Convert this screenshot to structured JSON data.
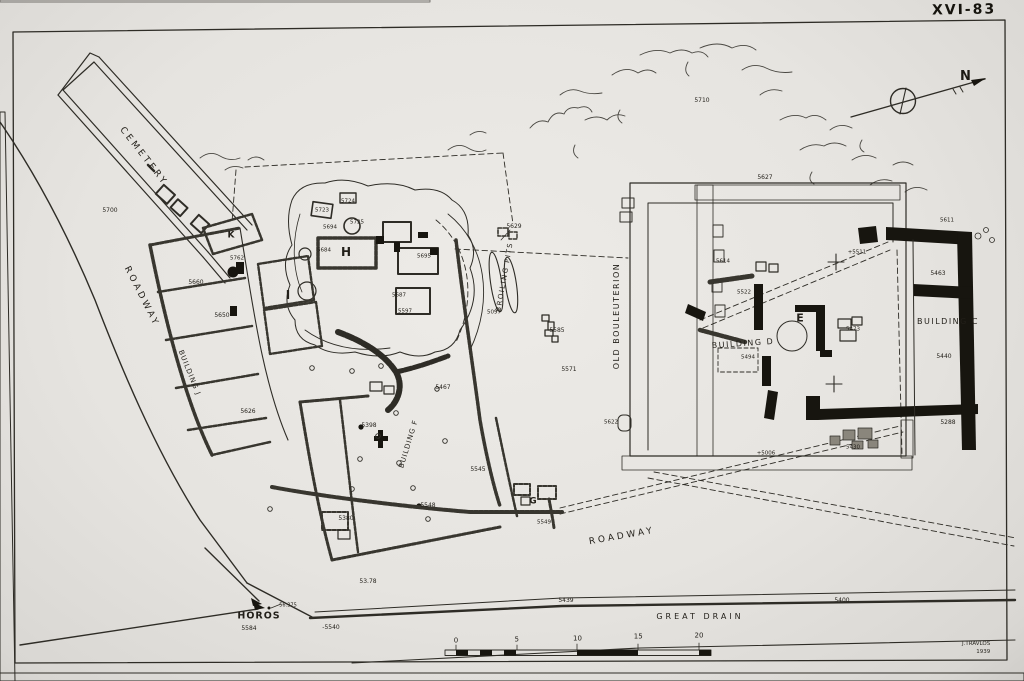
{
  "figure": {
    "plate_number": "XVI-83",
    "compass_label": "N",
    "signature_name": "J.TRAVLOS",
    "signature_year": "1939"
  },
  "scale_bar": {
    "ticks": [
      "0",
      "5",
      "10",
      "15",
      "20"
    ]
  },
  "labels": [
    {
      "t": "CEMETERY",
      "x": 143,
      "y": 157,
      "s": 9,
      "r": 52,
      "ls": 3
    },
    {
      "t": "5700",
      "x": 110,
      "y": 211,
      "s": 6
    },
    {
      "t": "ROADWAY",
      "x": 141,
      "y": 297,
      "s": 9,
      "r": 63,
      "ls": 3
    },
    {
      "t": "K",
      "x": 231,
      "y": 236,
      "s": 9,
      "w": 700
    },
    {
      "t": "5762",
      "x": 237,
      "y": 259,
      "s": 5.5
    },
    {
      "t": "5660",
      "x": 196,
      "y": 283,
      "s": 6
    },
    {
      "t": "5650",
      "x": 222,
      "y": 316,
      "s": 6
    },
    {
      "t": "BUILDING J",
      "x": 189,
      "y": 373,
      "s": 7,
      "r": 68,
      "ls": 1
    },
    {
      "t": "5626",
      "x": 248,
      "y": 412,
      "s": 6
    },
    {
      "t": "I",
      "x": 288,
      "y": 295,
      "s": 12,
      "w": 700
    },
    {
      "t": "5723",
      "x": 322,
      "y": 211,
      "s": 5.5
    },
    {
      "t": "5724",
      "x": 348,
      "y": 202,
      "s": 5.5
    },
    {
      "t": "5694",
      "x": 330,
      "y": 228,
      "s": 5.5
    },
    {
      "t": "5725",
      "x": 357,
      "y": 223,
      "s": 5.5
    },
    {
      "t": "5684",
      "x": 324,
      "y": 251,
      "s": 5.5
    },
    {
      "t": "H",
      "x": 346,
      "y": 252,
      "s": 12,
      "w": 700
    },
    {
      "t": "5695",
      "x": 424,
      "y": 257,
      "s": 5.5
    },
    {
      "t": "5629",
      "x": 514,
      "y": 227,
      "s": 6
    },
    {
      "t": "BROILING PITS",
      "x": 505,
      "y": 277,
      "s": 7,
      "r": -80,
      "ls": 1.5
    },
    {
      "t": "5097",
      "x": 494,
      "y": 313,
      "s": 5.5
    },
    {
      "t": "5585",
      "x": 557,
      "y": 331,
      "s": 6
    },
    {
      "t": "5571",
      "x": 569,
      "y": 370,
      "s": 6
    },
    {
      "t": "5687",
      "x": 399,
      "y": 296,
      "s": 5.5
    },
    {
      "t": "5597",
      "x": 405,
      "y": 312,
      "s": 5.5
    },
    {
      "t": "5467",
      "x": 443,
      "y": 388,
      "s": 6
    },
    {
      "t": "5398",
      "x": 369,
      "y": 426,
      "s": 6
    },
    {
      "t": "BUILDING F",
      "x": 409,
      "y": 444,
      "s": 7,
      "r": -73,
      "ls": 1
    },
    {
      "t": "5545",
      "x": 478,
      "y": 470,
      "s": 6
    },
    {
      "t": "5548",
      "x": 428,
      "y": 506,
      "s": 6
    },
    {
      "t": "5380",
      "x": 346,
      "y": 519,
      "s": 6
    },
    {
      "t": "G",
      "x": 533,
      "y": 502,
      "s": 9,
      "w": 700
    },
    {
      "t": "5549",
      "x": 544,
      "y": 523,
      "s": 5.5
    },
    {
      "t": "53.78",
      "x": 368,
      "y": 582,
      "s": 6
    },
    {
      "t": "ROADWAY",
      "x": 622,
      "y": 537,
      "s": 9,
      "r": -10,
      "ls": 3
    },
    {
      "t": "HOROS",
      "x": 259,
      "y": 616,
      "s": 9.5,
      "w": 700,
      "ls": 1
    },
    {
      "t": "5584",
      "x": 249,
      "y": 629,
      "s": 6
    },
    {
      "t": "56.375",
      "x": 288,
      "y": 606,
      "s": 5
    },
    {
      "t": "-5540",
      "x": 331,
      "y": 628,
      "s": 6
    },
    {
      "t": "5439",
      "x": 566,
      "y": 601,
      "s": 6
    },
    {
      "t": "5400",
      "x": 842,
      "y": 601,
      "s": 6
    },
    {
      "t": "GREAT DRAIN",
      "x": 700,
      "y": 617,
      "s": 8,
      "ls": 3
    },
    {
      "t": "OLD BOULEUTERION",
      "x": 617,
      "y": 316,
      "s": 8,
      "r": -90,
      "ls": 1.5
    },
    {
      "t": "5622",
      "x": 611,
      "y": 423,
      "s": 5.5
    },
    {
      "t": "5710",
      "x": 702,
      "y": 101,
      "s": 6
    },
    {
      "t": "5627",
      "x": 765,
      "y": 178,
      "s": 6
    },
    {
      "t": "5614",
      "x": 723,
      "y": 262,
      "s": 5.5
    },
    {
      "t": "5522",
      "x": 744,
      "y": 293,
      "s": 5.5
    },
    {
      "t": "BUILDING D",
      "x": 743,
      "y": 344,
      "s": 8,
      "r": -4,
      "ls": 1.5
    },
    {
      "t": "5494",
      "x": 748,
      "y": 358,
      "s": 5.5
    },
    {
      "t": "E",
      "x": 800,
      "y": 318,
      "s": 11,
      "w": 700
    },
    {
      "t": "5473",
      "x": 853,
      "y": 330,
      "s": 5.5
    },
    {
      "t": "+5511",
      "x": 857,
      "y": 253,
      "s": 5.5
    },
    {
      "t": "5611",
      "x": 947,
      "y": 221,
      "s": 5.5
    },
    {
      "t": "5463",
      "x": 938,
      "y": 274,
      "s": 6
    },
    {
      "t": "BUILDING C",
      "x": 948,
      "y": 322,
      "s": 8,
      "ls": 1.5
    },
    {
      "t": "5440",
      "x": 944,
      "y": 357,
      "s": 6
    },
    {
      "t": "5288",
      "x": 948,
      "y": 423,
      "s": 6
    },
    {
      "t": "5430",
      "x": 853,
      "y": 448,
      "s": 5.5
    },
    {
      "t": "+5006",
      "x": 766,
      "y": 454,
      "s": 5.5
    }
  ]
}
